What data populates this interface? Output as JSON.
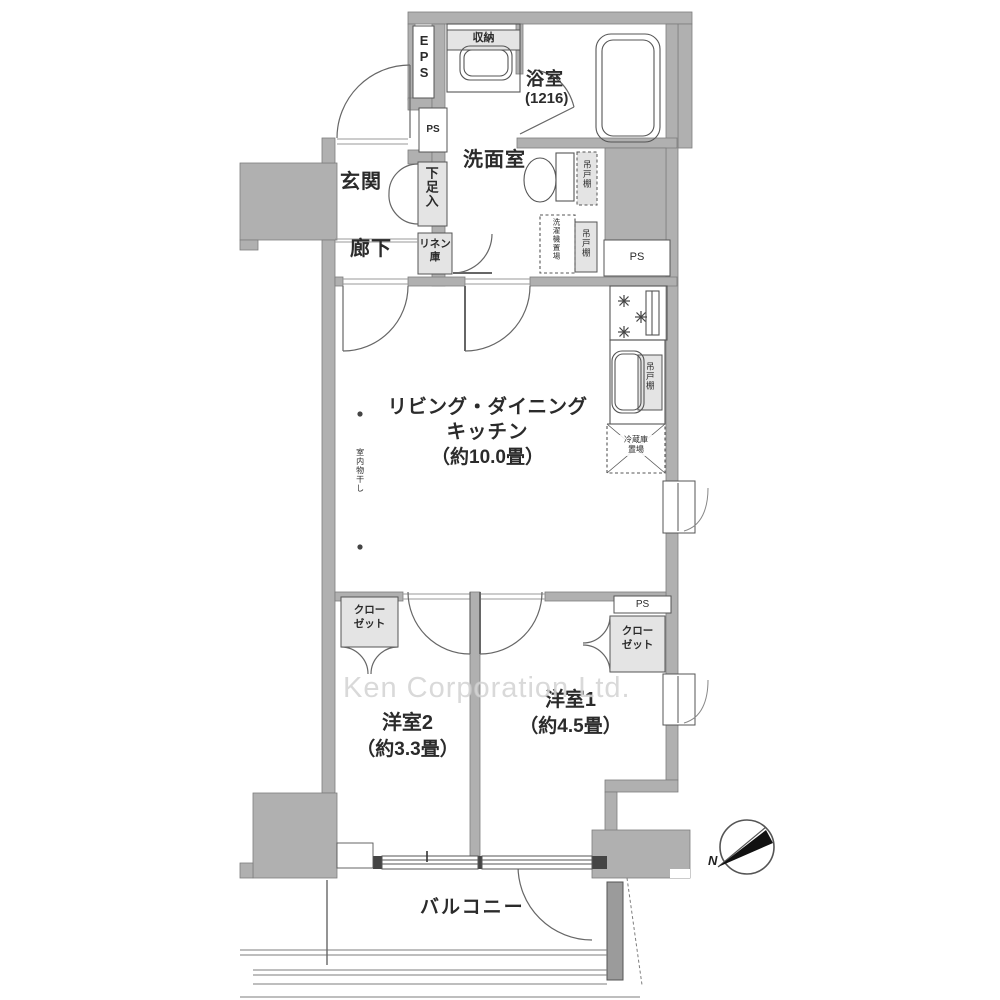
{
  "watermark": "Ken Corporation Ltd.",
  "compass": {
    "north_label": "N"
  },
  "labels": {
    "genkan": "玄関",
    "rouka": "廊下",
    "shoebox": "下足入",
    "eps": "EPS",
    "ps": "PS",
    "linen_l1": "リネン",
    "linen_l2": "庫",
    "senmen": "洗面室",
    "bath": "浴室",
    "bath_size": "(1216)",
    "shuno": "収納",
    "tsuridana": "吊戸棚",
    "sentakuki": "洗濯機置場",
    "reizoko_l1": "冷蔵庫",
    "reizoko_l2": "置場",
    "ldk_l1": "リビング・ダイニング",
    "ldk_l2": "キッチン",
    "ldk_size": "（約10.0畳）",
    "monohoshi": "室内物干し",
    "room2": "洋室2",
    "room2_size": "（約3.3畳）",
    "room1": "洋室1",
    "room1_size": "（約4.5畳）",
    "closet_l1": "クロー",
    "closet_l2": "ゼット",
    "balcony": "バルコニー"
  }
}
